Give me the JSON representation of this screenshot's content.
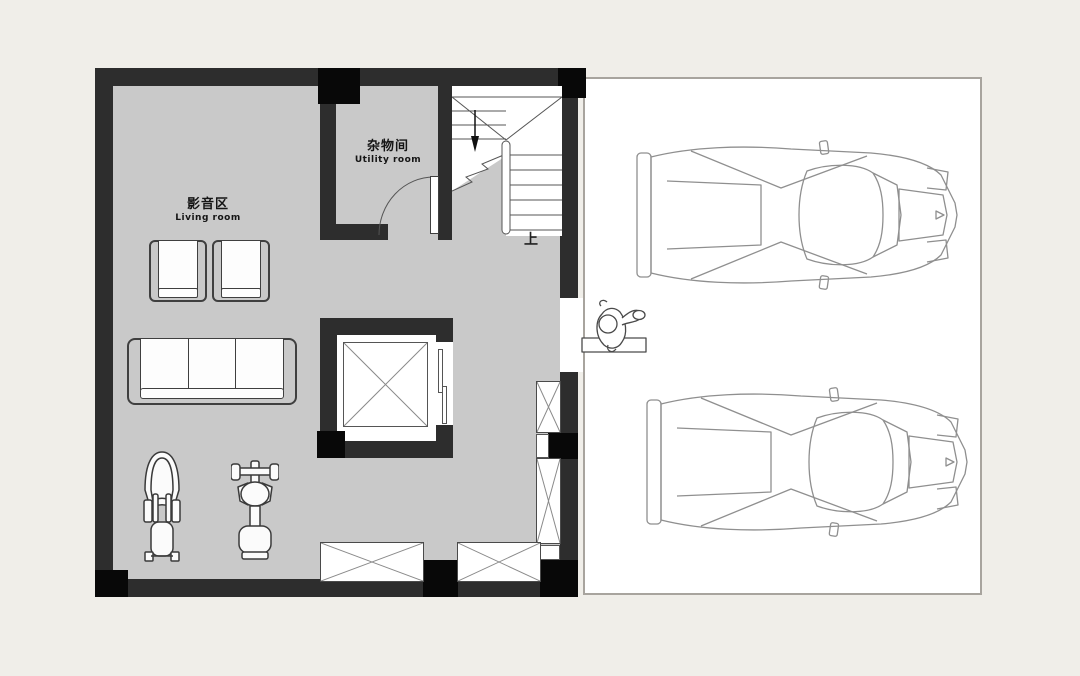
{
  "canvas": {
    "width": 1080,
    "height": 676
  },
  "colors": {
    "background": "#f0eee9",
    "floor": "#c9c9c9",
    "wall": "#2d2d2d",
    "wall_black": "#080808",
    "garage_floor": "#ffffff",
    "garage_border": "#a8a49e",
    "furniture_line": "#3f3f3f",
    "car_line": "#8f8f8f"
  },
  "labels": {
    "living_zh": "影音区",
    "living_en": "Living room",
    "utility_zh": "杂物间",
    "utility_en": "Utility room",
    "stairs_up": "上"
  },
  "objects": {
    "living_area": [
      "armchair",
      "armchair",
      "three-seat-sofa",
      "exercise-bike",
      "weight-bench"
    ],
    "core": [
      "utility-door",
      "u-shaped-staircase",
      "elevator-shaft",
      "storage-x-boxes"
    ],
    "garage": [
      "sports-car-top-view",
      "sports-car-top-view",
      "person-figure"
    ]
  }
}
